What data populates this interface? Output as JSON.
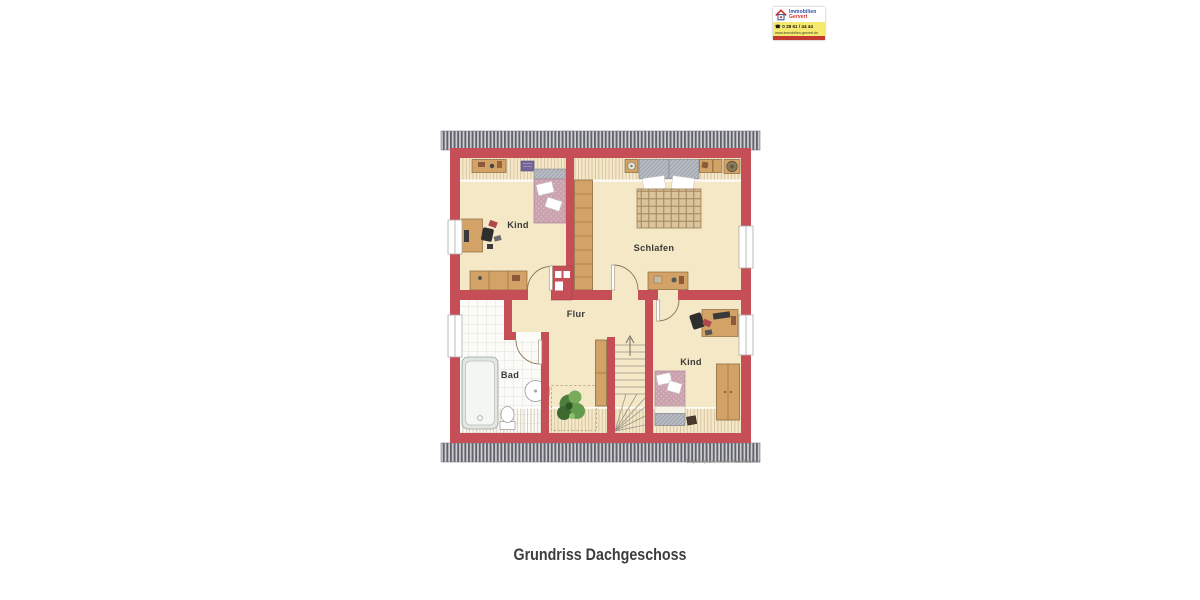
{
  "title": {
    "text": "Grundriss Dachgeschoss"
  },
  "plan": {
    "disclaimer": "Exposeplan, nicht maßstäblich",
    "rooms": [
      {
        "id": "kind-top-left",
        "label": "Kind"
      },
      {
        "id": "schlafen",
        "label": "Schlafen"
      },
      {
        "id": "flur",
        "label": "Flur"
      },
      {
        "id": "bad",
        "label": "Bad"
      },
      {
        "id": "kind-bottom-right",
        "label": "Kind"
      }
    ],
    "colors": {
      "wall": "#c54e57",
      "floor": "#f4e8c7",
      "roof_dark": "#62626b",
      "roof_light": "#d0d0d6",
      "wood": "#d2a266",
      "bed_pink": "#c9a2ae",
      "plaid": "#d9c49c",
      "tile": "#fbfbf7"
    }
  },
  "logo": {
    "company_line1": "Immobilien",
    "company_line2": "Gervert",
    "phone_icon": "☎",
    "phone": "0 28 61 / 44 44",
    "website": "www.immobilien-gervert.de",
    "colors": {
      "blue": "#2b4f9e",
      "red": "#d03028",
      "yellow": "#f5e96e",
      "bar_red": "#c23b2e"
    }
  }
}
